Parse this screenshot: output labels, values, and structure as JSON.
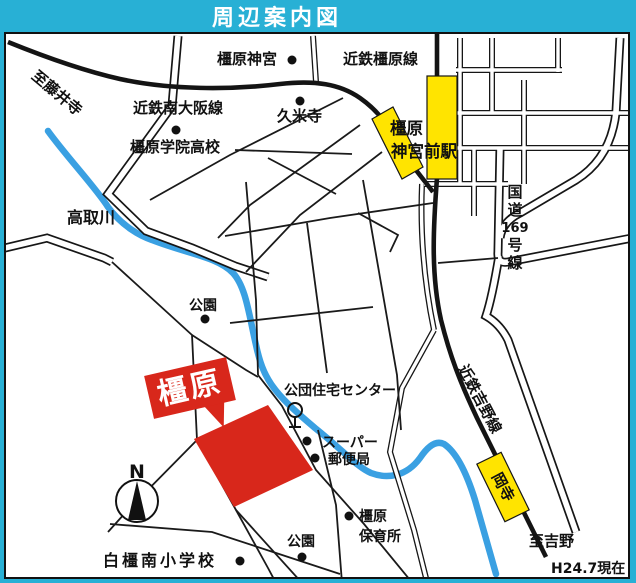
{
  "title": "周辺案内図",
  "note_date": "H24.7現在",
  "colors": {
    "frame_cyan": "#28b0d5",
    "station_yellow": "#ffe400",
    "highlight_red": "#d8271b",
    "river_blue": "#3aa0e2"
  },
  "railways": {
    "kashihara_line": "近鉄橿原線",
    "minami_osaka_line": "近鉄南大阪線",
    "yoshino_line": "近鉄吉野線"
  },
  "roads": {
    "route169_chars": [
      "国",
      "道",
      "169",
      "号",
      "線"
    ],
    "route169_full": "国道169号線"
  },
  "river": {
    "name": "高取川"
  },
  "directions": {
    "to_fujiidera": "至藤井寺",
    "to_yoshino": "至吉野"
  },
  "stations": {
    "jingumae_line1": "橿原",
    "jingumae_line2": "神宮前駅",
    "okadera": "岡寺"
  },
  "pois": {
    "kashihara_shrine": "橿原神宮",
    "kumedera": "久米寺",
    "gakuin_hs": "橿原学院高校",
    "park_upper": "公園",
    "kodan_center": "公団住宅センター",
    "supermarket": "スーパー",
    "post_office": "郵便局",
    "hoikusho_line1": "橿原",
    "hoikusho_line2": "保育所",
    "park_lower": "公園",
    "shirakashi_es": "白橿南小学校"
  },
  "highlight": {
    "name": "橿原"
  },
  "compass": {
    "north": "N"
  }
}
